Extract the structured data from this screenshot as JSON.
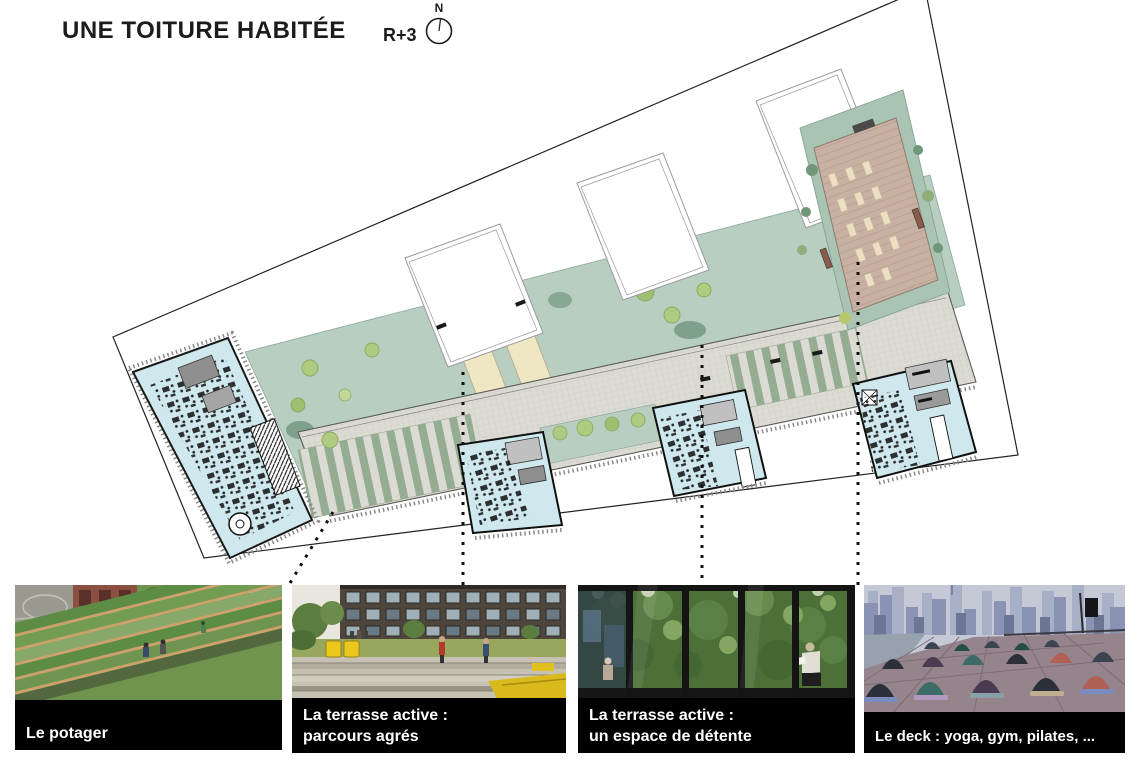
{
  "header": {
    "title": "UNE TOITURE HABITÉE",
    "level_label": "R+3",
    "north_label": "N"
  },
  "plan": {
    "name": "roof-plan-level-3",
    "colors": {
      "site_outline": "#222222",
      "paving_grey": "#dcdbd3",
      "courtyard_green": "#b7cec1",
      "tree_green": "#aecb7f",
      "dark_shrub_green": "#6f9678",
      "stripe_green": "#94ac91",
      "interior_blue": "#cfe8ee",
      "deck_tan": "#c8b1a3",
      "lawn_cream": "#efe7c3",
      "caption_bar": "#000000",
      "caption_text": "#ffffff"
    }
  },
  "photos": [
    {
      "caption": "Le potager"
    },
    {
      "caption": "La terrasse active :\nparcours agrés"
    },
    {
      "caption": "La terrasse active :\nun espace de détente"
    },
    {
      "caption": "Le deck : yoga, gym, pilates, ..."
    }
  ]
}
